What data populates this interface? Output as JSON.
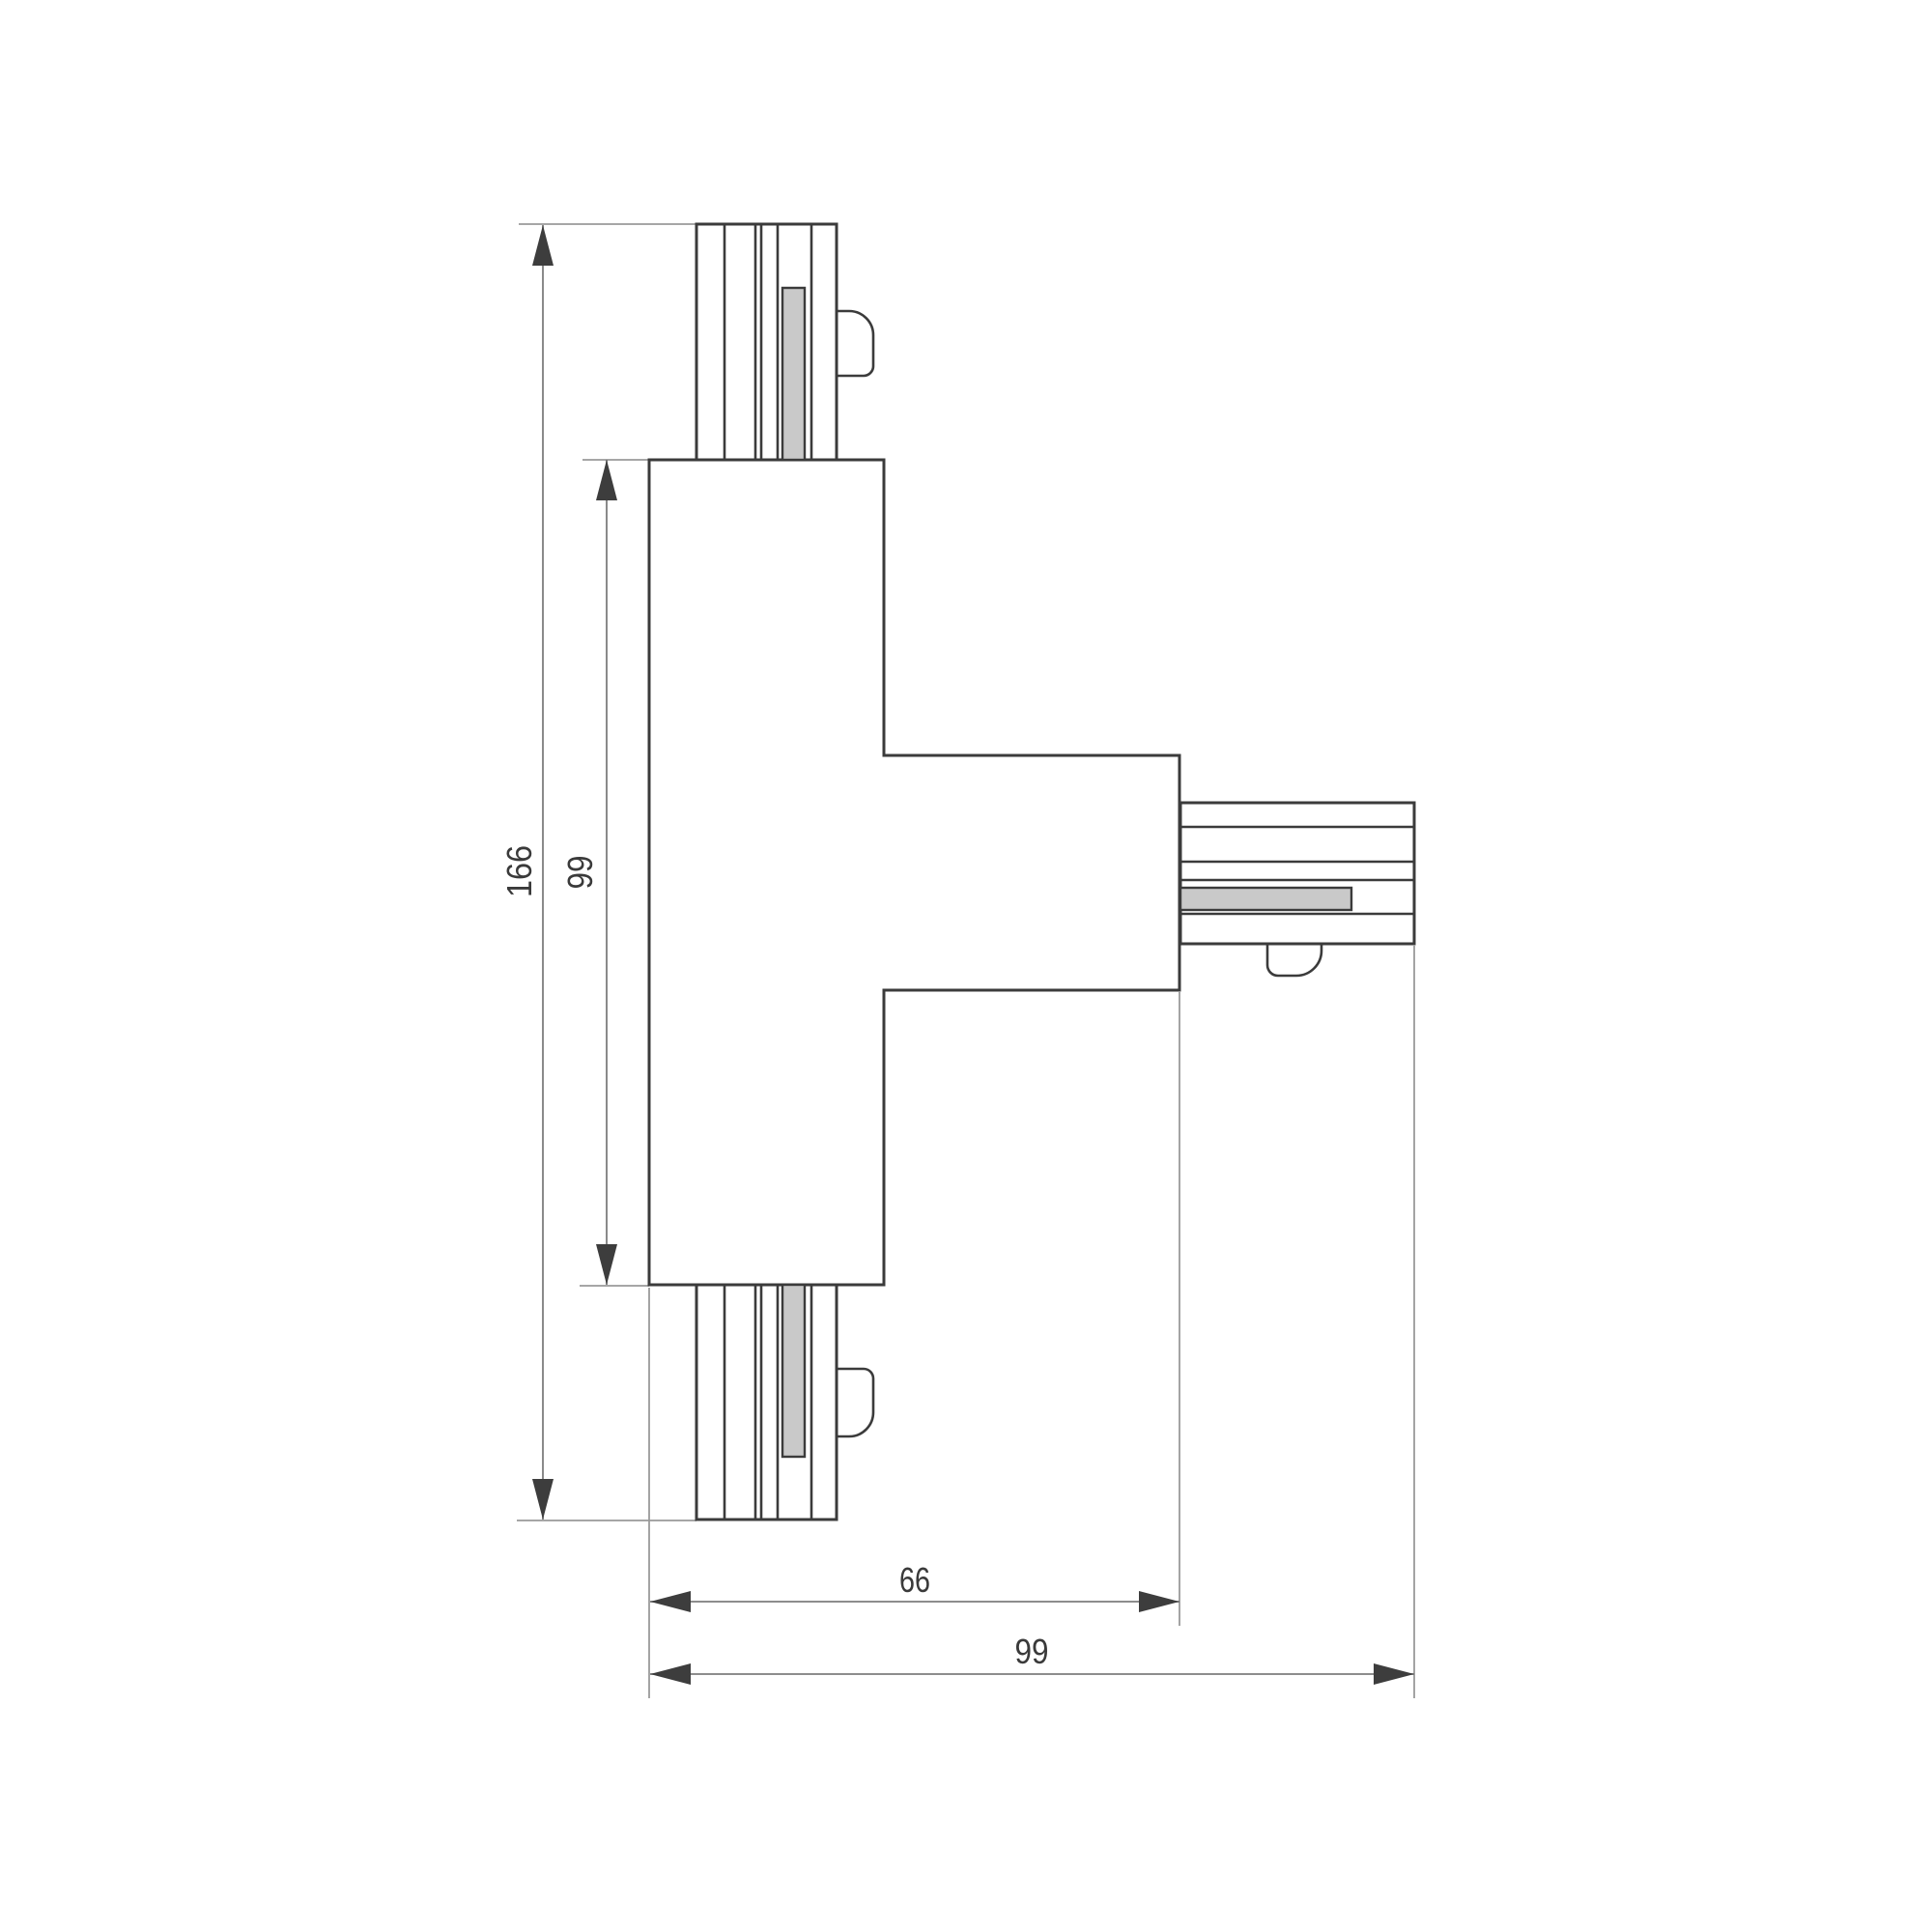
{
  "drawing": {
    "background_color": "#ffffff",
    "outline_color": "#3b3b3b",
    "thin_line_color": "#8c8c8c",
    "arrow_color": "#3d3d3d",
    "text_color": "#3a3a3a",
    "contact_fill_color": "#c9c9c9"
  },
  "dimensions": {
    "overall_height": "166",
    "body_height": "99",
    "body_width": "66",
    "overall_width": "99"
  }
}
